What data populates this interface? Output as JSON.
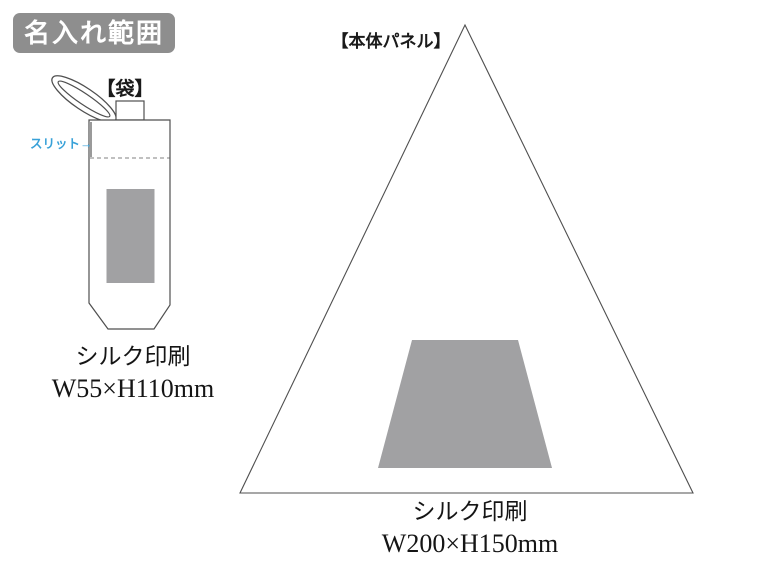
{
  "colors": {
    "badge_bg": "#8e8e8e",
    "badge_text": "#ffffff",
    "print_gray": "#a1a1a3",
    "slit_blue": "#38a1d8",
    "line": "#4f4f4f",
    "slit_mark": "#9a9a9a",
    "dash": "#808080"
  },
  "badge": {
    "label": "名入れ範囲"
  },
  "bag": {
    "title": "【袋】",
    "slit_label": "スリット→",
    "print_method": "シルク印刷",
    "print_size": "W55×H110mm"
  },
  "panel": {
    "title": "【本体パネル】",
    "print_method": "シルク印刷",
    "print_size": "W200×H150mm"
  }
}
